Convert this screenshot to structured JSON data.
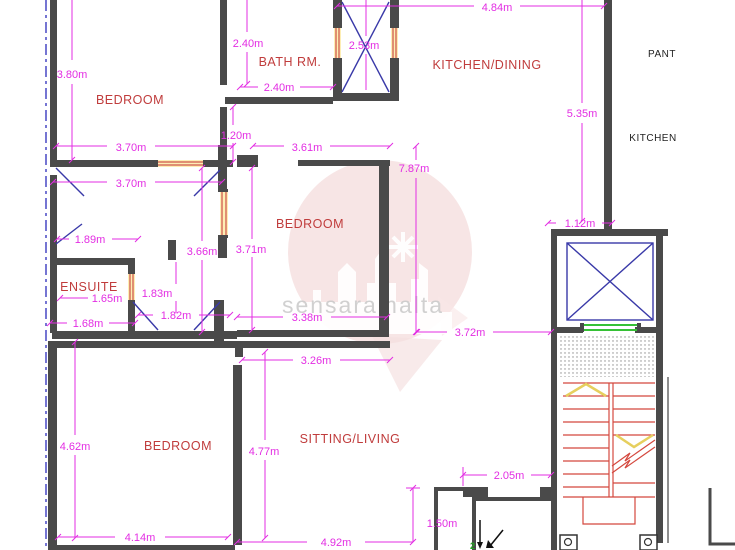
{
  "document": {
    "type": "architectural floor plan"
  },
  "watermark": {
    "text": "sensaramalta"
  },
  "rooms": [
    {
      "id": "bedroom-top-left",
      "label": "BEDROOM"
    },
    {
      "id": "bath-room",
      "label": "BATH RM."
    },
    {
      "id": "kitchen-dining",
      "label": "KITCHEN/DINING"
    },
    {
      "id": "bedroom-middle",
      "label": "BEDROOM"
    },
    {
      "id": "ensuite",
      "label": "ENSUITE"
    },
    {
      "id": "bedroom-bottom",
      "label": "BEDROOM"
    },
    {
      "id": "sitting-living",
      "label": "SITTING/LIVING"
    },
    {
      "id": "pantry-adjacent",
      "label": "PANT"
    },
    {
      "id": "kitchen-adjacent",
      "label": "KITCHEN"
    }
  ],
  "dimensions": [
    "3.80m",
    "2.40m",
    "2.53m",
    "4.84m",
    "2.40m",
    "5.35m",
    "1.20m",
    "3.70m",
    "3.61m",
    "7.87m",
    "3.70m",
    "1.12m",
    "1.89m",
    "3.66m",
    "3.71m",
    "1.65m",
    "1.83m",
    "1.82m",
    "3.38m",
    "1.68m",
    "3.72m",
    "3.26m",
    "4.62m",
    "4.77m",
    "2.05m",
    "4.14m",
    "1.50m",
    "4.92m"
  ],
  "entrance": {
    "marker": "2"
  },
  "colors": {
    "wall": "#4a4a4a",
    "dimension": "#e32ee3",
    "room_label": "#c03c3c",
    "door_swing_blue": "#3939a8",
    "window_fill": "#fdeeb4",
    "window_line": "#c23030",
    "stair_red": "#d4483e",
    "chevron_yellow": "#e6cf5e",
    "elevator_door_green": "#35c135",
    "boundary_dashed_blue": "#3b3bc0",
    "watermark_pink": "#f5dede",
    "watermark_text": "#c9c9c9"
  }
}
